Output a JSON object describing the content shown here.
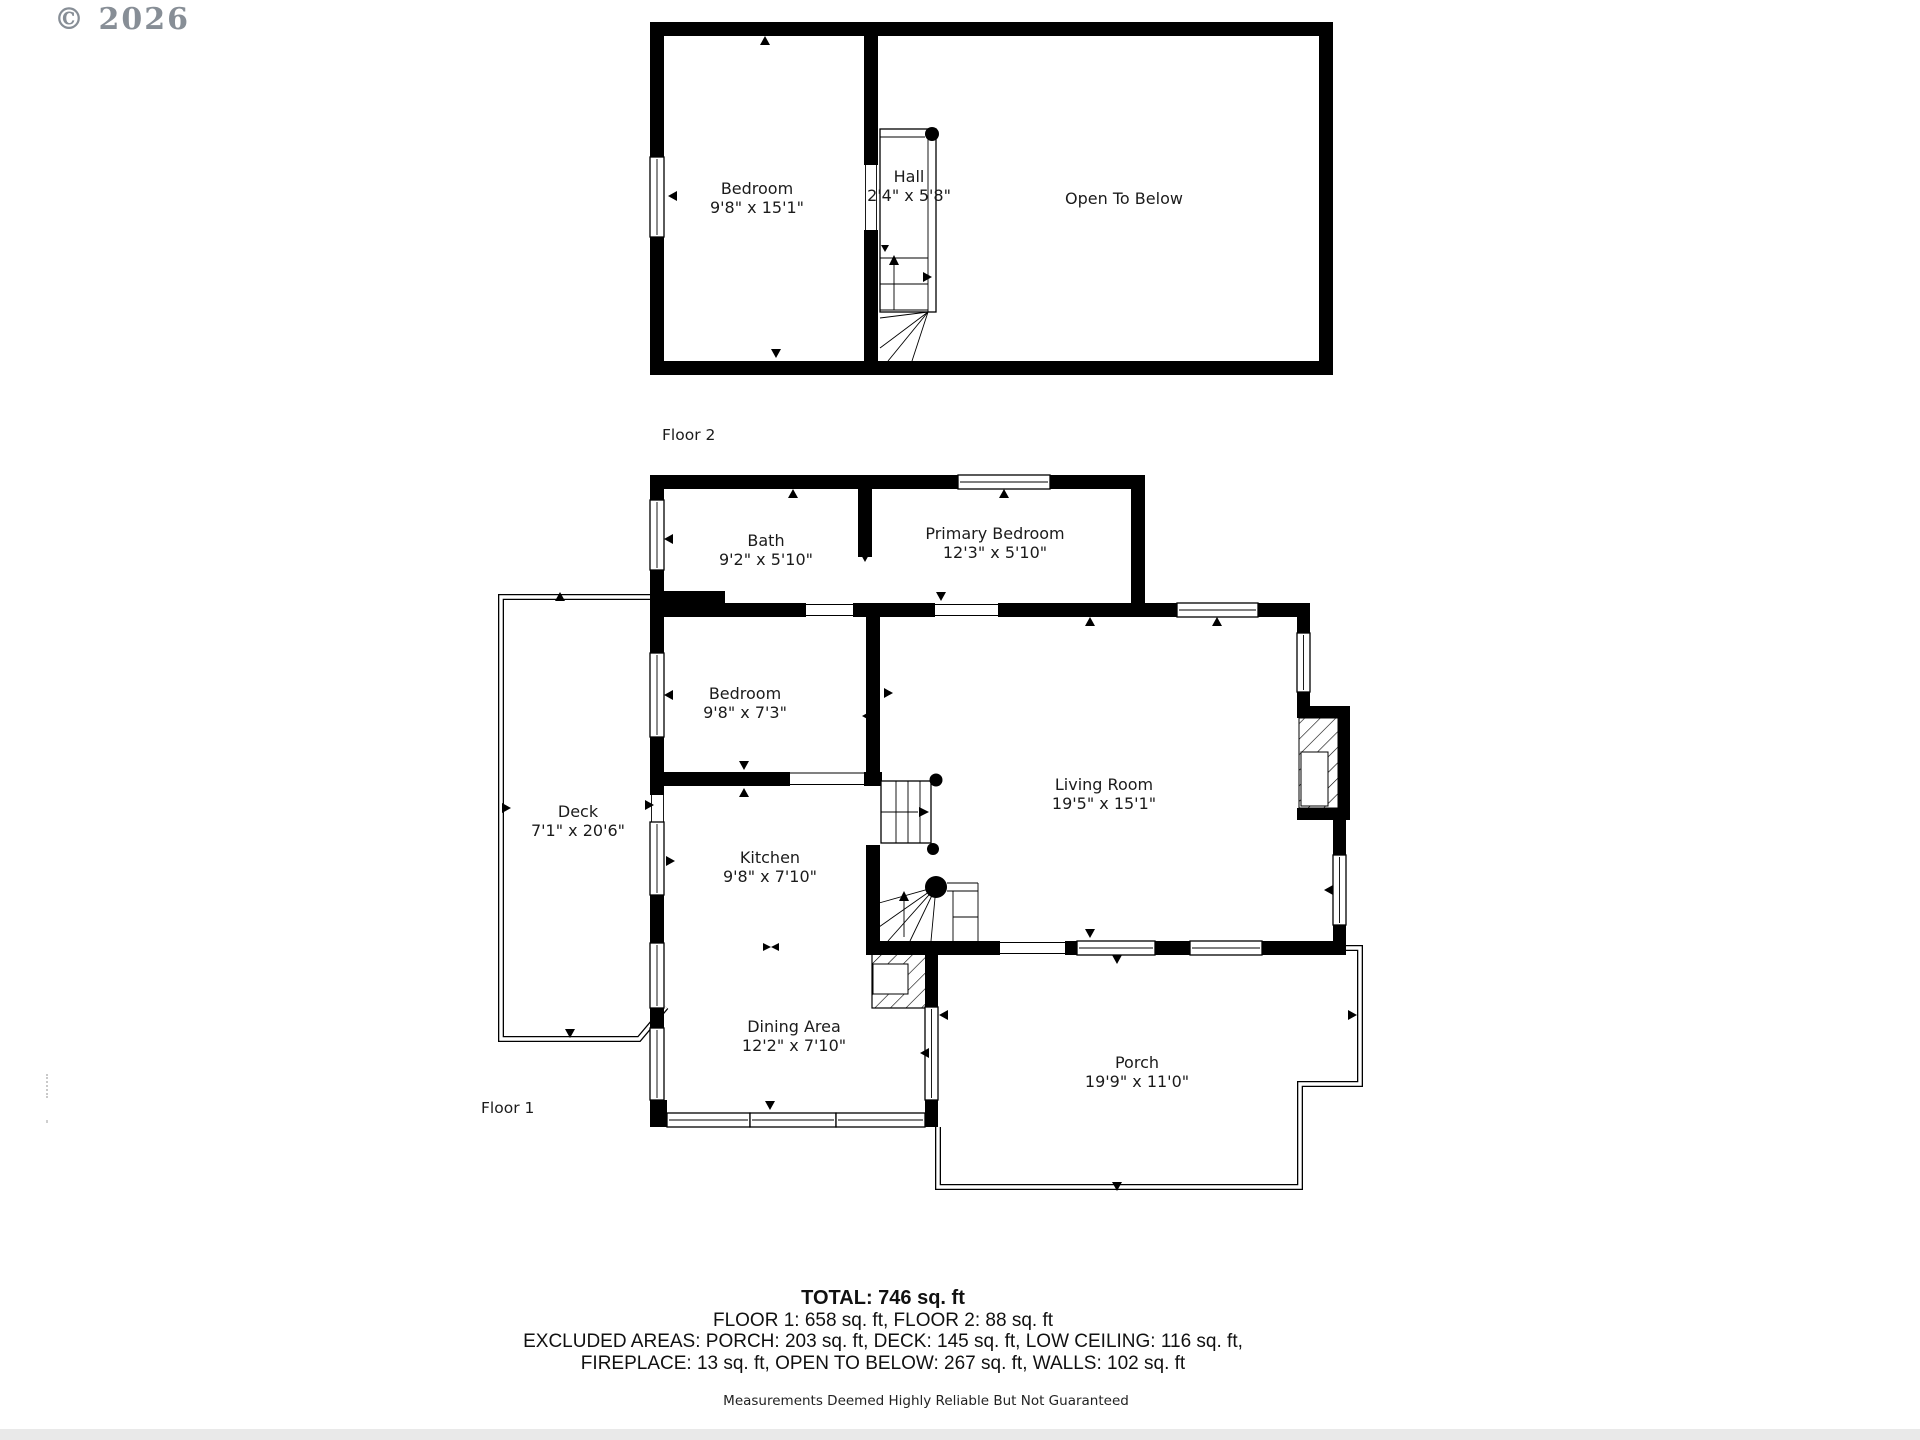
{
  "watermark": "© 2026",
  "floor2": {
    "label": "Floor 2",
    "rooms": [
      {
        "name": "Bedroom",
        "dims": "9'8\" x 15'1\""
      },
      {
        "name": "Hall",
        "dims": "2'4\" x 5'8\""
      },
      {
        "name": "Open To Below",
        "dims": ""
      }
    ]
  },
  "floor1": {
    "label": "Floor 1",
    "rooms": [
      {
        "name": "Bath",
        "dims": "9'2\" x 5'10\""
      },
      {
        "name": "Primary Bedroom",
        "dims": "12'3\" x 5'10\""
      },
      {
        "name": "Bedroom",
        "dims": "9'8\" x 7'3\""
      },
      {
        "name": "Living Room",
        "dims": "19'5\" x 15'1\""
      },
      {
        "name": "Deck",
        "dims": "7'1\" x 20'6\""
      },
      {
        "name": "Kitchen",
        "dims": "9'8\" x 7'10\""
      },
      {
        "name": "Dining Area",
        "dims": "12'2\" x 7'10\""
      },
      {
        "name": "Porch",
        "dims": "19'9\" x 11'0\""
      }
    ]
  },
  "summary": {
    "total": "TOTAL: 746 sq. ft",
    "floors": "FLOOR 1: 658 sq. ft, FLOOR 2: 88 sq. ft",
    "excluded1": "EXCLUDED AREAS: PORCH: 203 sq. ft, DECK: 145 sq. ft, LOW CEILING: 116 sq. ft,",
    "excluded2": "FIREPLACE: 13 sq. ft, OPEN TO BELOW: 267 sq. ft, WALLS: 102 sq. ft",
    "disclaimer": "Measurements Deemed Highly Reliable But Not Guaranteed"
  },
  "colors": {
    "wall": "#000000",
    "watermark": "#878e96",
    "text": "#1b1b1b"
  }
}
